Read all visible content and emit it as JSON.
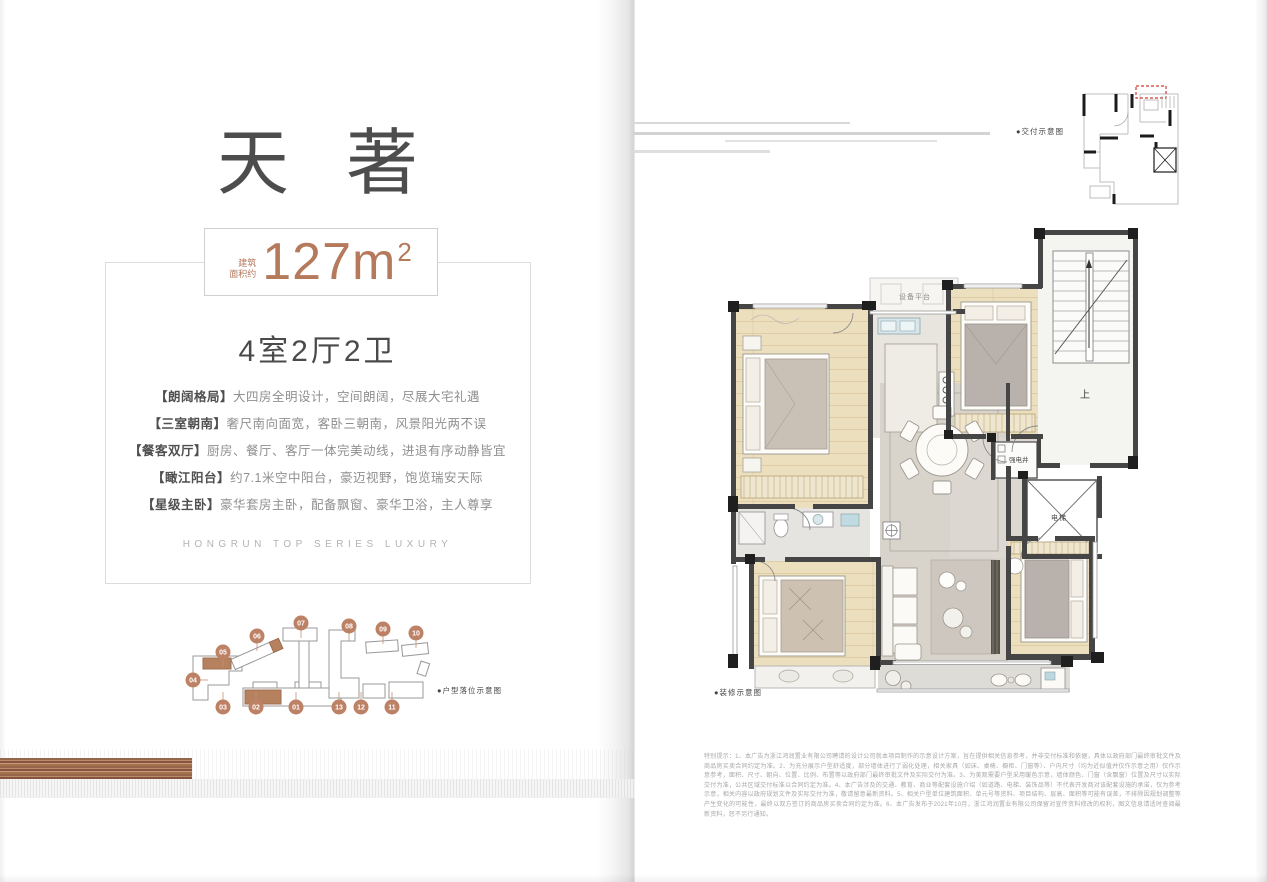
{
  "left_page": {
    "title": "天著",
    "area_badge": {
      "prefix_line1": "建筑",
      "prefix_line2": "面积约",
      "value": "127m",
      "sup": "2"
    },
    "layout_summary": "4室2厅2卫",
    "features": [
      {
        "label": "【朗阔格局】",
        "text": "大四房全明设计，空间朗阔，尽展大宅礼遇"
      },
      {
        "label": "【三室朝南】",
        "text": "奢尺南向面宽，客卧三朝南，风景阳光两不误"
      },
      {
        "label": "【餐客双厅】",
        "text": "厨房、餐厅、客厅一体完美动线，进退有序动静皆宜"
      },
      {
        "label": "【瞰江阳台】",
        "text": "约7.1米空中阳台，豪迈视野，饱览瑞安天际"
      },
      {
        "label": "【星级主卧】",
        "text": "豪华套房主卧，配备飘窗、豪华卫浴，主人尊享"
      }
    ],
    "series_tagline": "HONGRUN TOP SERIES LUXURY",
    "siteplan": {
      "caption": "●户型落位示意图",
      "buildings": [
        "01",
        "02",
        "03",
        "04",
        "05",
        "06",
        "07",
        "08",
        "09",
        "10",
        "11",
        "12",
        "13"
      ],
      "highlighted": [
        "02",
        "05",
        "06"
      ]
    }
  },
  "right_page": {
    "delivery_caption": "●交付示意图",
    "plan_caption": "●装修示意图",
    "plan_labels": {
      "equipment_platform": "设备平台",
      "electric_shaft": "强电井",
      "elevator": "电梯",
      "stairs_up": "上"
    },
    "disclaimer": "特别提示：1、本广告为浙江鸿润置业有限公司聘请的设计公司就本项目制作的示意设计方案，旨在提供相关信息参考，并非交付标准和依据，具体以政府部门最终审批文件及商品房买卖合同约定为准。2、为充分展示户型舒适度，部分墙体进行了弱化处理，相关家具（如床、桌椅、橱柜、门窗等）、户内尺寸（均为近似值并仅作示意之用）仅作示意参考，面积、尺寸、朝向、位置、比例、布置等以政府部门最终审批文件及实际交付为准。3、为美观需要户型采用暖色示意，墙体颜色、门窗（含飘窗）位置及尺寸以实际交付为准，公共区域交付标准以合同约定为准。4、本广告涉及的交通、教育、商业等配套设施介绍（如道路、电梯、装饰品等）不代表开发商对该配套设施的承诺，仅为参考示意，相关内容以政府规划文件及实际交付为准，敬请留意最新资料。5、相关户型单位建筑面积、单元号等资料、项目结构、层高、面积等可能有误差，不排除因规划调整等产生变化的可能性，最终以双方签订的商品房买卖合同约定为准。6、本广告发布于2021年10月，浙江鸿润置业有限公司保留对宣传资料修改的权利，图文信息请适时查阅最新资料，恕不另行通知。"
  },
  "colors": {
    "accent": "#b5795c",
    "site_circle": "#bd8165",
    "title_text": "#4d4d4d",
    "wall": "#454545"
  }
}
